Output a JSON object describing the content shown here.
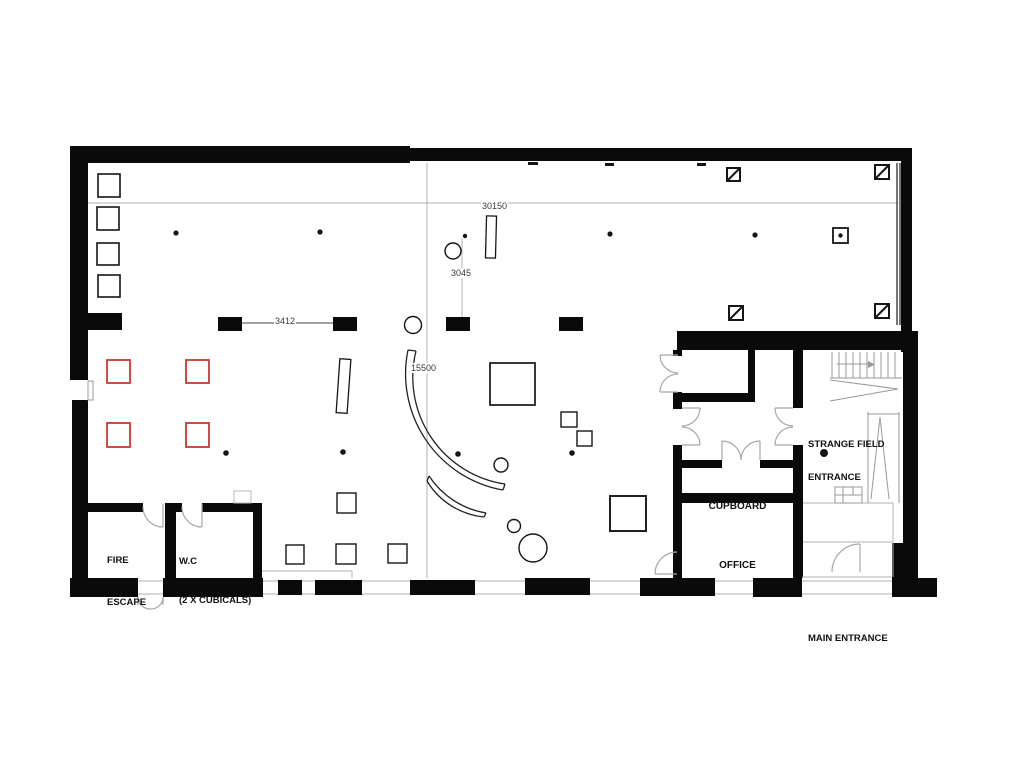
{
  "plan": {
    "rooms": {
      "fire_escape": {
        "label_line1": "FIRE",
        "label_line2": "ESCAPE"
      },
      "wc": {
        "label_line1": "W.C",
        "label_line2": "(2 X CUBICALS)"
      },
      "cupboard": {
        "label": "CUPBOARD"
      },
      "office": {
        "label": "OFFICE"
      },
      "strange_field_entrance": {
        "label_line1": "STRANGE FIELD",
        "label_line2": "ENTRANCE"
      },
      "main_entrance": {
        "label": "MAIN ENTRANCE"
      }
    },
    "dimensions": {
      "overall_width": "30150",
      "bay_depth": "3045",
      "column_spacing": "3412",
      "arc_radius": "15500"
    },
    "colors": {
      "wall": "#0a0a0a",
      "ink": "#161616",
      "red_accent": "#c63a35",
      "line": "#b0b0b0",
      "door": "#a8a8a8"
    }
  }
}
